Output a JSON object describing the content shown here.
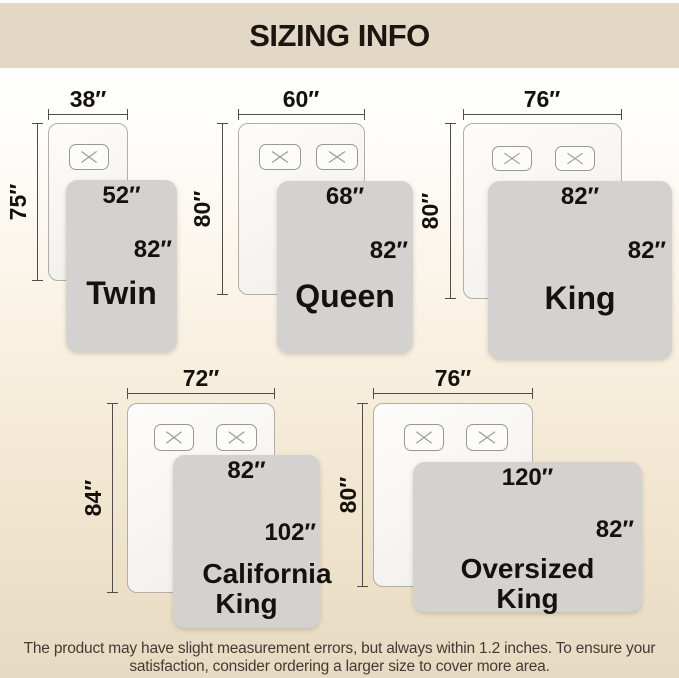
{
  "title": "SIZING INFO",
  "colors": {
    "title_bar_bg": "#e3d8c5",
    "title_text": "#1c1610",
    "blanket_fill": "#d3d2d0",
    "mattress_fill": "#f8f6f2",
    "dimension_line": "#4e4e4c",
    "label_text": "#14110d",
    "footer_text": "#403c35",
    "background_bottom": "#e7dac2"
  },
  "diagrams": [
    {
      "id": "twin",
      "name": "Twin",
      "mattress_width": "38″",
      "mattress_height": "75″",
      "blanket_width": "52″",
      "blanket_height": "82″",
      "pillow_count": 1
    },
    {
      "id": "queen",
      "name": "Queen",
      "mattress_width": "60″",
      "mattress_height": "80″",
      "blanket_width": "68″",
      "blanket_height": "82″",
      "pillow_count": 2
    },
    {
      "id": "king",
      "name": "King",
      "mattress_width": "76″",
      "mattress_height": "80″",
      "blanket_width": "82″",
      "blanket_height": "82″",
      "pillow_count": 2
    },
    {
      "id": "california-king",
      "name": "California King",
      "mattress_width": "72″",
      "mattress_height": "84″",
      "blanket_width": "82″",
      "blanket_height": "102″",
      "pillow_count": 2
    },
    {
      "id": "oversized-king",
      "name": "Oversized King",
      "mattress_width": "76″",
      "mattress_height": "80″",
      "blanket_width": "120″",
      "blanket_height": "82″",
      "pillow_count": 2
    }
  ],
  "footer": {
    "line1": "The product may have slight measurement errors, but always within 1.2 inches. To ensure your",
    "line2": "satisfaction, consider ordering a larger size to cover more area."
  }
}
